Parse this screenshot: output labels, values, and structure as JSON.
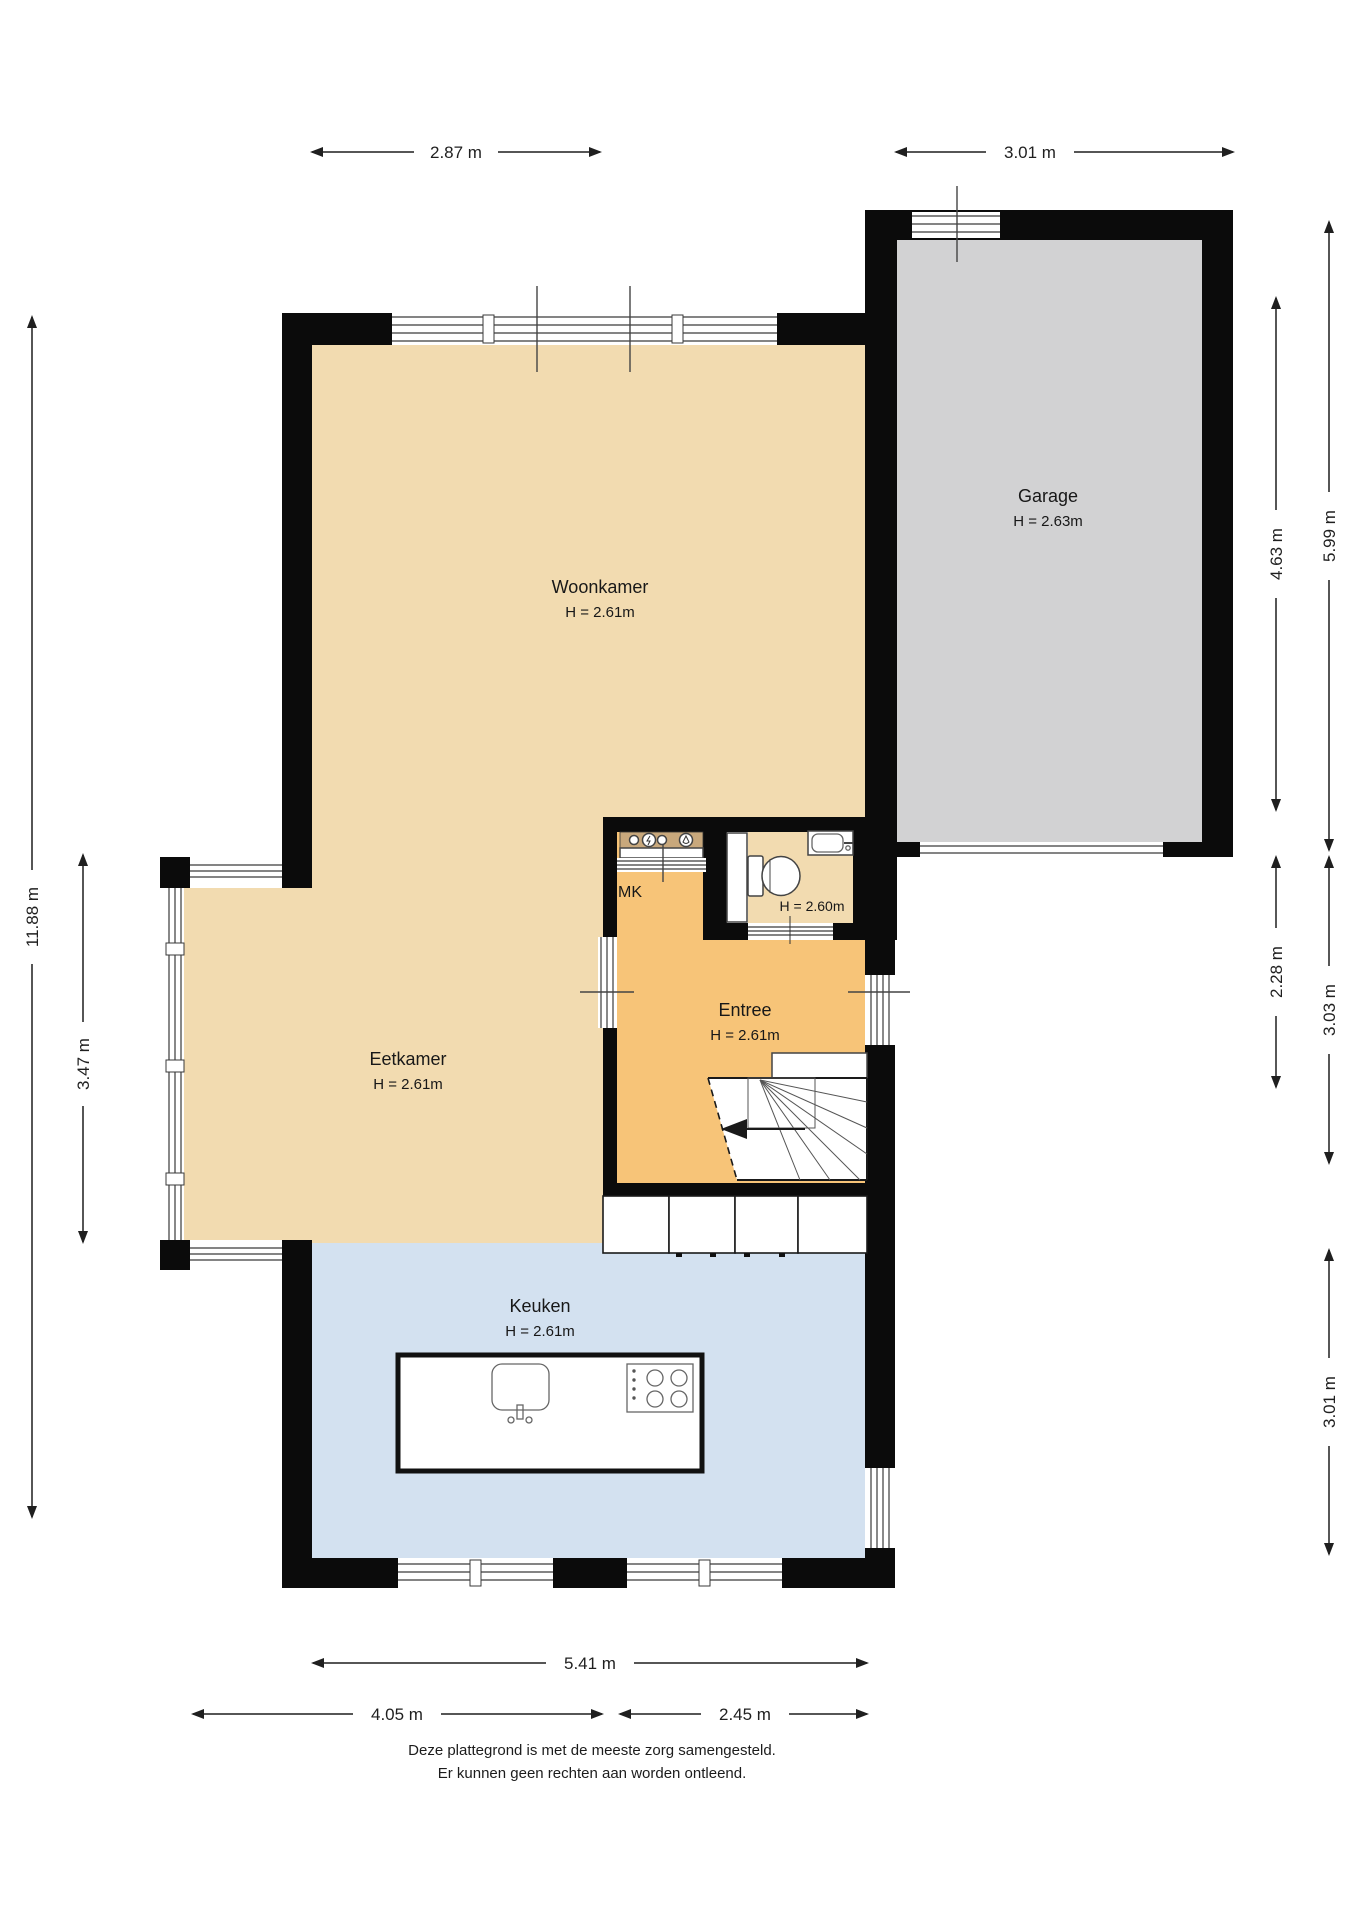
{
  "rooms": {
    "woonkamer": {
      "name": "Woonkamer",
      "height": "H = 2.61m",
      "floor_color": "#F2DBB0"
    },
    "garage": {
      "name": "Garage",
      "height": "H = 2.63m",
      "floor_color": "#D2D2D3"
    },
    "eetkamer": {
      "name": "Eetkamer",
      "height": "H = 2.61m",
      "floor_color": "#F2DBB0"
    },
    "entree": {
      "name": "Entree",
      "height": "H = 2.61m",
      "floor_color": "#F7C478"
    },
    "keuken": {
      "name": "Keuken",
      "height": "H = 2.61m",
      "floor_color": "#D3E1F0"
    },
    "mk": {
      "name": "MK",
      "floor_color": "#F7C478"
    },
    "toilet": {
      "height": "H = 2.60m",
      "floor_color": "#F2DBB0"
    }
  },
  "dimensions": {
    "top": [
      {
        "label": "2.87 m"
      },
      {
        "label": "3.01 m"
      }
    ],
    "bottom": [
      {
        "label": "5.41 m"
      },
      {
        "label": "4.05 m"
      },
      {
        "label": "2.45 m"
      }
    ],
    "left": [
      {
        "label": "11.88 m"
      },
      {
        "label": "3.47 m"
      }
    ],
    "right": [
      {
        "label": "5.99 m"
      },
      {
        "label": "4.63 m"
      },
      {
        "label": "2.28 m"
      },
      {
        "label": "3.03 m"
      },
      {
        "label": "3.01 m"
      }
    ]
  },
  "footer": {
    "line1": "Deze plattegrond is met de meeste zorg samengesteld.",
    "line2": "Er kunnen geen rechten aan worden ontleend."
  },
  "fixtures": [
    "winder-staircase",
    "toilet",
    "hand-basin",
    "meter-cabinet",
    "kitchen-island",
    "island-sink",
    "cooktop",
    "garage-door",
    "kitchen-cabinets"
  ],
  "colors": {
    "wall": "#0b0b0b",
    "floor_beige": "#F2DBB0",
    "floor_orange": "#F7C478",
    "floor_gray": "#D2D2D3",
    "floor_blue": "#D3E1F0",
    "dimension": "#1f1f1f",
    "background": "#ffffff"
  }
}
